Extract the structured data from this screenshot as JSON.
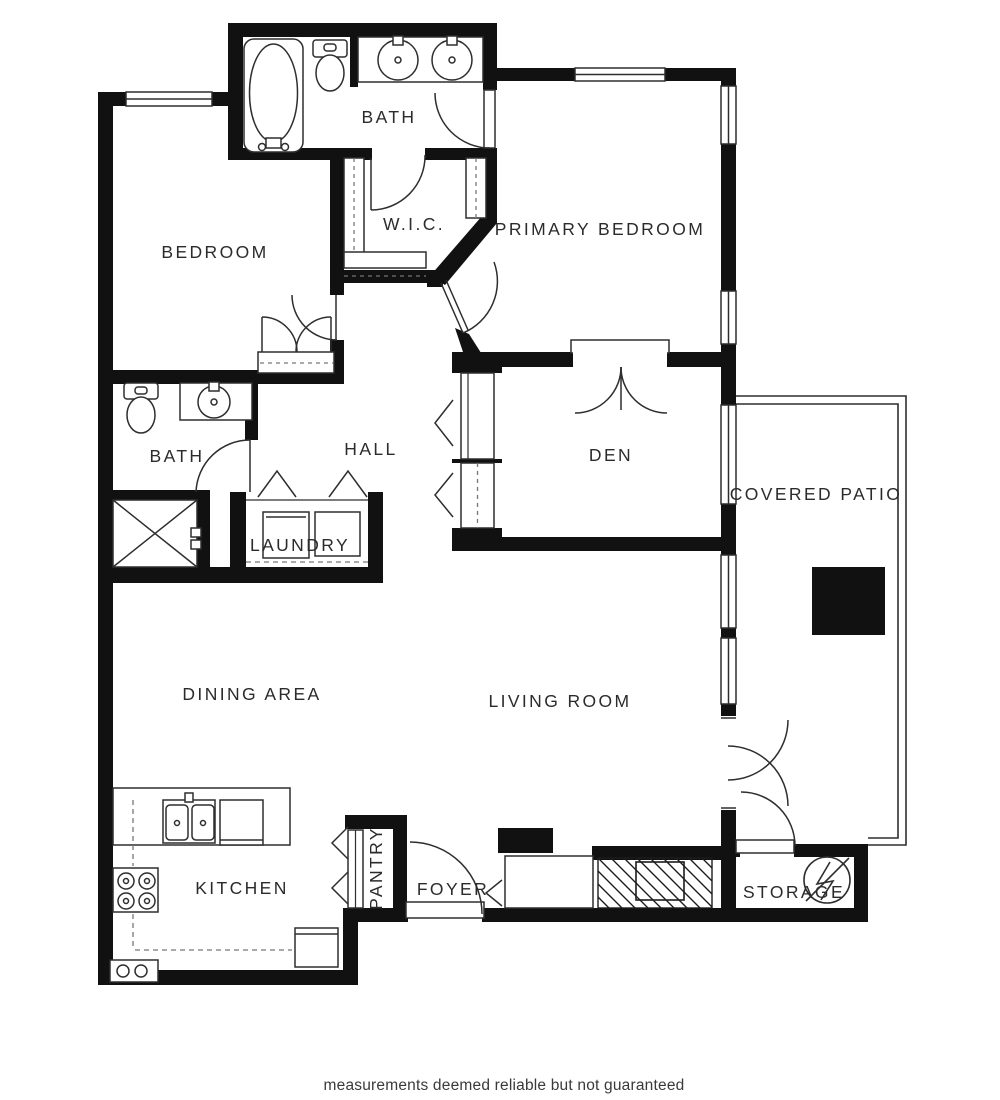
{
  "colors": {
    "wall": "#111111",
    "line": "#2e2e2e",
    "dash": "#777777",
    "label_text": "#2b2b2b",
    "disclaimer_text": "#3a3a3a",
    "background": "#ffffff"
  },
  "labels": {
    "bath_top": "BATH",
    "wic": "W.I.C.",
    "bedroom": "BEDROOM",
    "primary_bedroom": "PRIMARY BEDROOM",
    "den": "DEN",
    "hall": "HALL",
    "bath_lower": "BATH",
    "laundry": "LAUNDRY",
    "covered_patio": "COVERED PATIO",
    "dining_area": "DINING AREA",
    "living_room": "LIVING ROOM",
    "kitchen": "KITCHEN",
    "pantry": "PANTRY",
    "foyer": "FOYER",
    "storage": "STORAGE"
  },
  "footer": {
    "disclaimer": "measurements deemed reliable but not guaranteed"
  }
}
